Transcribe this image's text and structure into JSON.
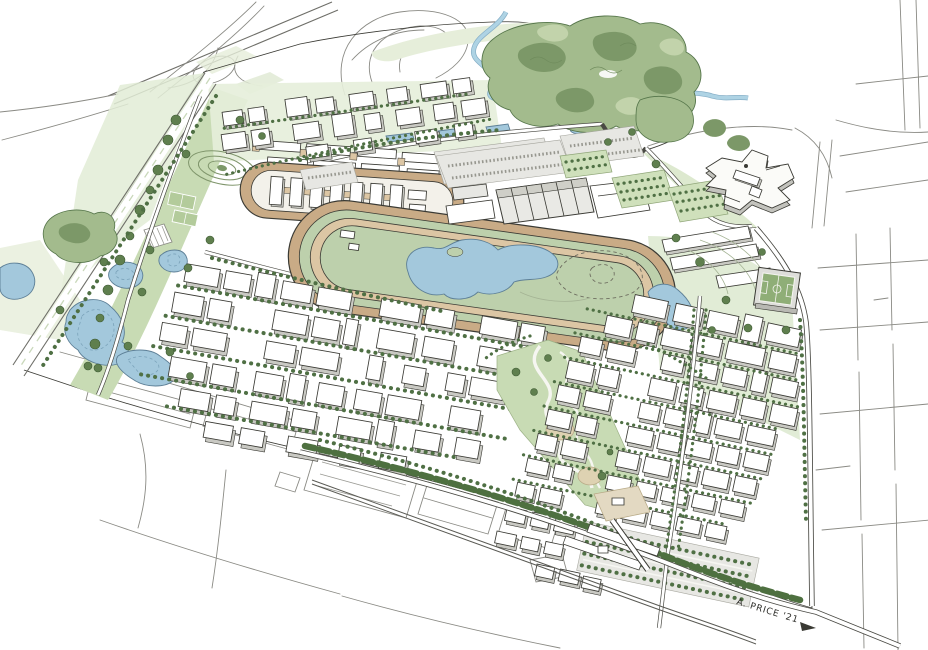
{
  "illustration": {
    "signature": "A. PRICE '21"
  },
  "palette": {
    "paper": "#ffffff",
    "ink": "#3a3a34",
    "sketch": "#8a8a84",
    "ground": "#d8e4c9",
    "ground_light": "#e6eeda",
    "park": "#c8dbb4",
    "canopy": "#a3bb8d",
    "canopy_dark": "#7c9868",
    "tree": "#4f7044",
    "water": "#a3c8dc",
    "water_edge": "#5d7f96",
    "creek": "#aed3e4",
    "track": "#c9ab86",
    "track_light": "#dcc6a4",
    "infield": "#bdd0ac",
    "building": "#ffffff",
    "building_side": "#c9c9c3",
    "asphalt": "#e7e7e3",
    "pitch": "#8fae77",
    "plaza": "#e3d9c2",
    "hedge": "#4e7040"
  }
}
